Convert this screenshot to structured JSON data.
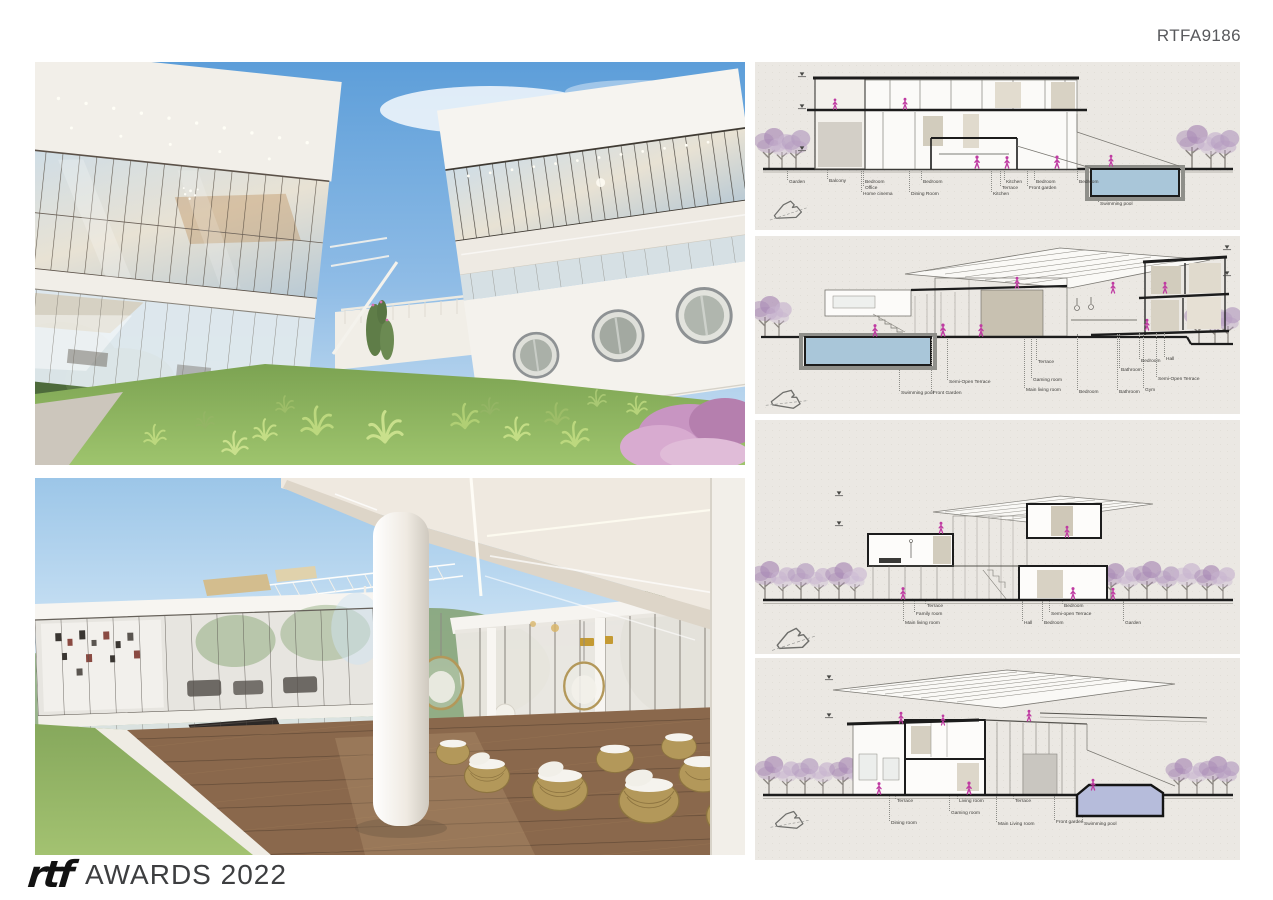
{
  "board": {
    "code": "RTFA9186",
    "footer": {
      "logo_text": "rtf",
      "title": "AWARDS 2022"
    }
  },
  "renderings": [
    {
      "id": "exterior-courtyard",
      "description": "White modern villa courtyard with glass facades, porthole wall, lawn and pink shrubs"
    },
    {
      "id": "covered-terrace",
      "description": "Covered wood deck terrace with ceiling light strips, round column, wicker furniture and glazed piano room"
    }
  ],
  "sections": [
    {
      "id": "section-1",
      "labels": [
        "Garden",
        "Balcony",
        "Bedroom",
        "Office",
        "Home cinema",
        "Bedroom",
        "Dining Room",
        "Kitchen",
        "Terrace",
        "Kitchen",
        "Bedroom",
        "Front garden",
        "Bedroom",
        "Swimming pool"
      ]
    },
    {
      "id": "section-2",
      "labels": [
        "Swimming pool",
        "Front Garden",
        "Semi-Open Terrace",
        "Main living room",
        "Gaming room",
        "Terrace",
        "Bedroom",
        "Bathroom",
        "Bathroom",
        "Gym",
        "Bedroom",
        "Semi-Open Terrace",
        "Hall"
      ]
    },
    {
      "id": "section-3",
      "labels": [
        "Main living room",
        "Family room",
        "Terrace",
        "Hall",
        "Bedroom",
        "Semi-open Terrace",
        "Bedroom",
        "Garden"
      ]
    },
    {
      "id": "section-4",
      "labels": [
        "Dining room",
        "Terrace",
        "Gaming room",
        "Living room",
        "Terrace",
        "Main Living room",
        "Front garden",
        "Swimming pool"
      ]
    }
  ],
  "colors": {
    "pool": "#a9c6d9",
    "pool_alt": "#b6bcdb",
    "tree": "#a98bb5",
    "tree_light": "#c7b4cf",
    "figure": "#bf3ba2",
    "ink": "#1c1c1c",
    "paper": "#ebe8e3"
  }
}
